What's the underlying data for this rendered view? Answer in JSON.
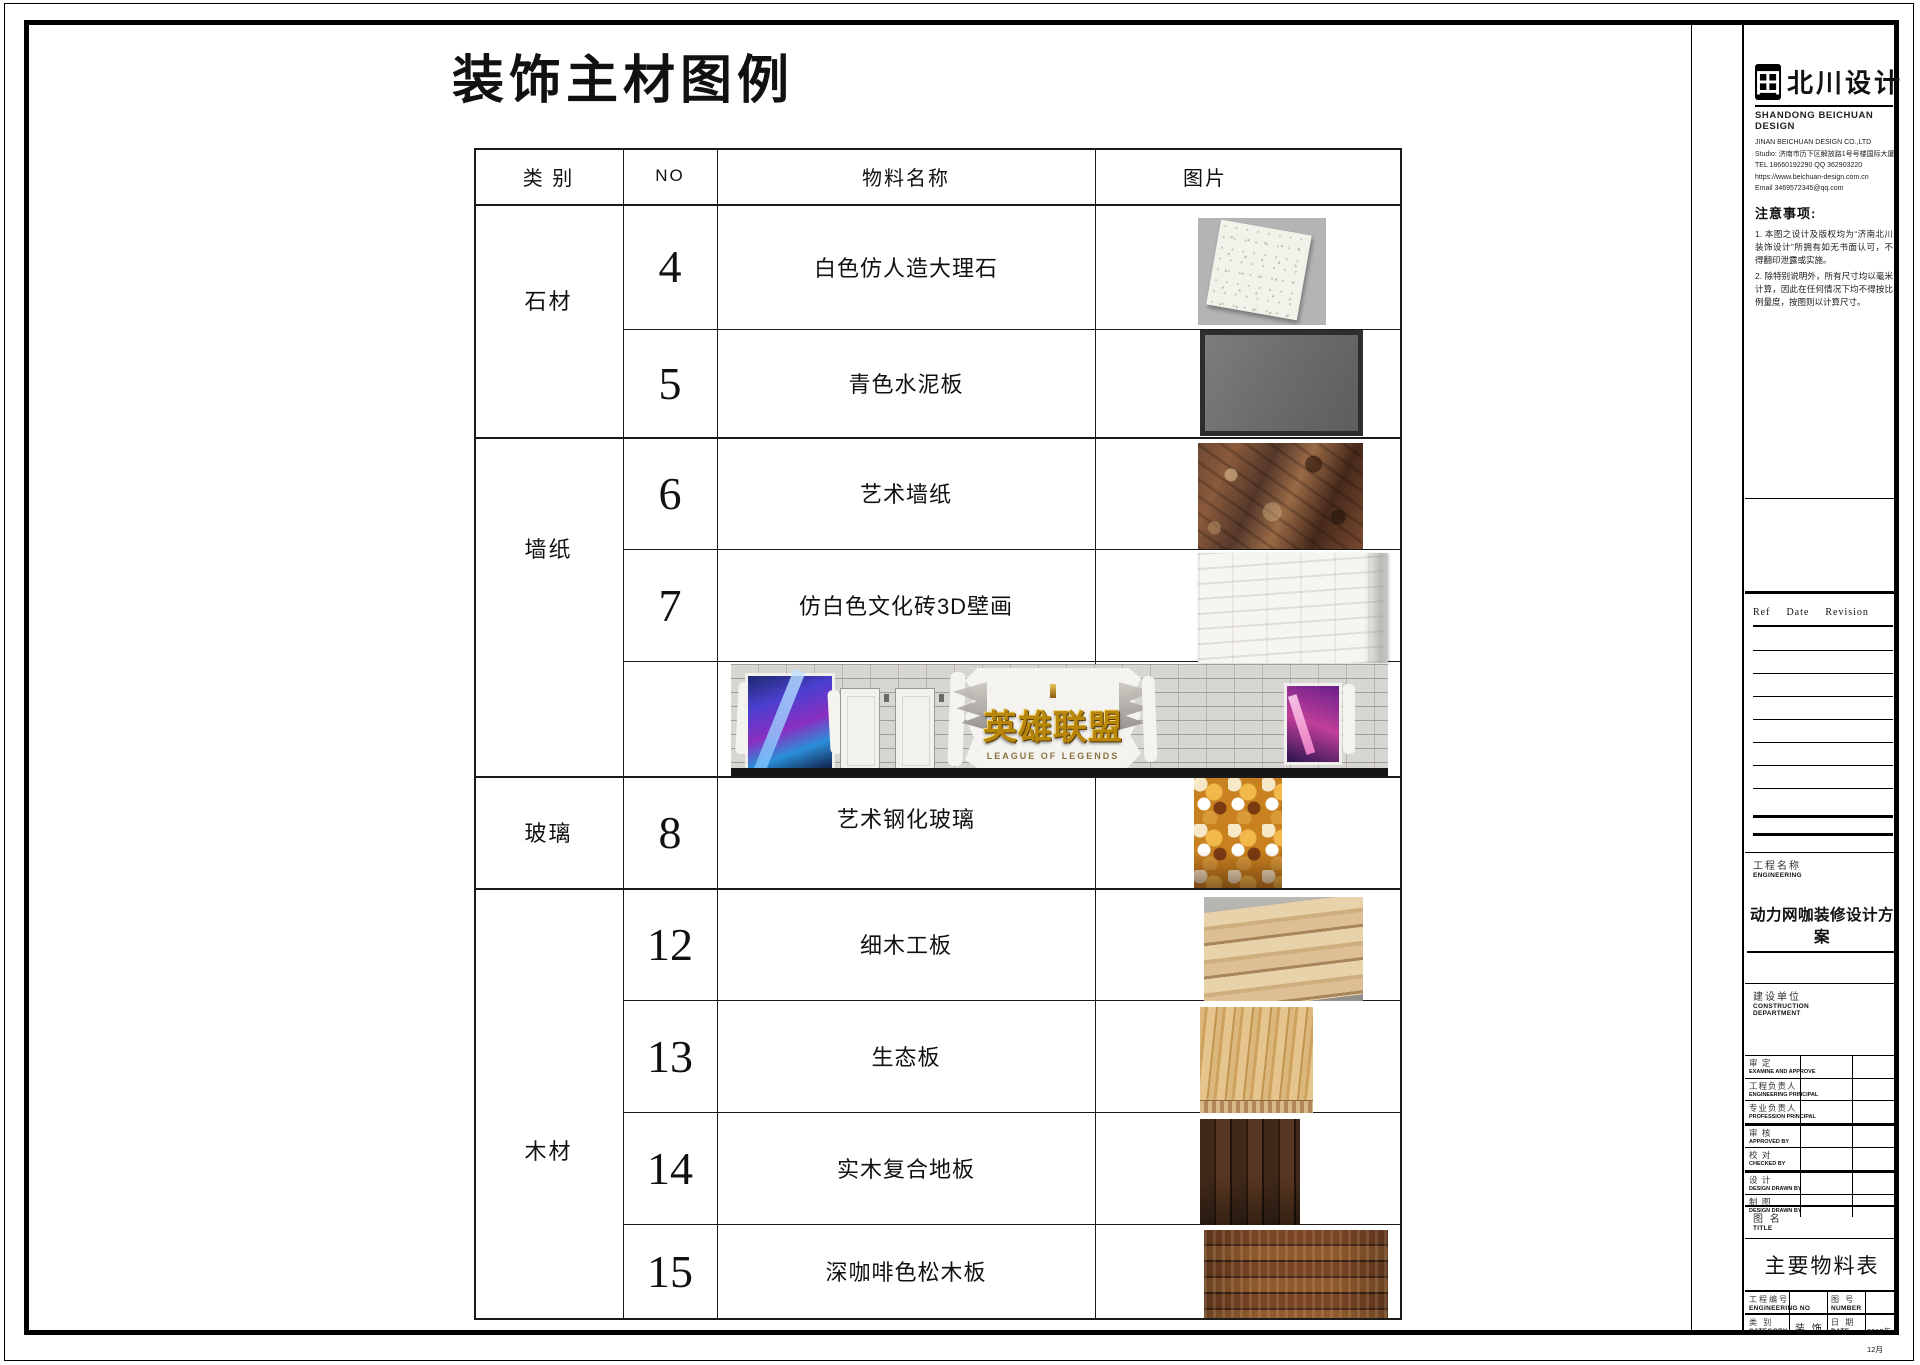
{
  "page": {
    "main_title": "装饰主材图例"
  },
  "table": {
    "headers": {
      "category": "类 别",
      "no": "NO",
      "name": "物料名称",
      "image": "图片"
    },
    "categories": [
      {
        "label": "石材"
      },
      {
        "label": "墙纸"
      },
      {
        "label": "玻璃"
      },
      {
        "label": "木材"
      }
    ],
    "rows": [
      {
        "no": "4",
        "name": "白色仿人造大理石"
      },
      {
        "no": "5",
        "name": "青色水泥板"
      },
      {
        "no": "6",
        "name": "艺术墙纸"
      },
      {
        "no": "7",
        "name": "仿白色文化砖3D壁画"
      },
      {
        "no": "8",
        "name": "艺术钢化玻璃"
      },
      {
        "no": "12",
        "name": "细木工板"
      },
      {
        "no": "13",
        "name": "生态板"
      },
      {
        "no": "14",
        "name": "实木复合地板"
      },
      {
        "no": "15",
        "name": "深咖啡色松木板"
      }
    ],
    "banner": {
      "logo_cn": "英雄联盟",
      "logo_en": "LEAGUE OF LEGENDS"
    }
  },
  "titleblock": {
    "brand": {
      "glyph": "田",
      "name": "北川设计",
      "subtitle": "SHANDONG BEICHUAN DESIGN"
    },
    "company_lines": [
      "JINAN BEICHUAN DESIGN CO.,LTD",
      "Studio: 济南市历下区解放路1号号楼国际大厦A座",
      "TEL 18660192290      QQ 362903220",
      "https://www.beichuan-design.com.cn",
      "Email 3469572345@qq.com"
    ],
    "notes": {
      "title": "注意事项:",
      "items": [
        "1. 本图之设计及版权均为“济南北川装饰设计”所拥有如无书面认可，不得翻印泄露或实施。",
        "2. 除特别说明外，所有尺寸均以毫米计算，因此在任何情况下均不得按比例量度，按图则以计算尺寸。"
      ]
    },
    "revision": {
      "ref": "Ref",
      "date": "Date",
      "rev": "Revision"
    },
    "engineering": {
      "cn": "工程名称",
      "en": "ENGINEERING",
      "value": "动力网咖装修设计方案"
    },
    "construction": {
      "cn": "建设单位",
      "en": "CONSTRUCTION DEPARTMENT"
    },
    "approvals": [
      {
        "cn": "审  定",
        "en": "EXAMINE AND APPROVE"
      },
      {
        "cn": "工程负责人",
        "en": "ENGINEERING PRINCIPAL"
      },
      {
        "cn": "专业负责人",
        "en": "PROFESSION PRINCIPAL"
      },
      {
        "cn": "审  核",
        "en": "APPROVED BY"
      },
      {
        "cn": "校  对",
        "en": "CHECKED BY"
      },
      {
        "cn": "设  计",
        "en": "DESIGN DRAWN BY"
      },
      {
        "cn": "制  图",
        "en": "DESIGN DRAWN BY"
      }
    ],
    "drawing_title": {
      "cn": "图 名",
      "en": "TITLE",
      "value": "主要物料表"
    },
    "footer": {
      "eng_no_cn": "工程编号",
      "eng_no_en": "ENGINEERING NO",
      "eng_no_value": "",
      "number_cn": "图  号",
      "number_en": "NUMBER",
      "number_value": "",
      "category_cn": "类  别",
      "category_en": "CATEGORY",
      "category_value": "装 饰",
      "date_cn": "日  期",
      "date_en": "DATE",
      "date_value": "2015年12月"
    }
  }
}
